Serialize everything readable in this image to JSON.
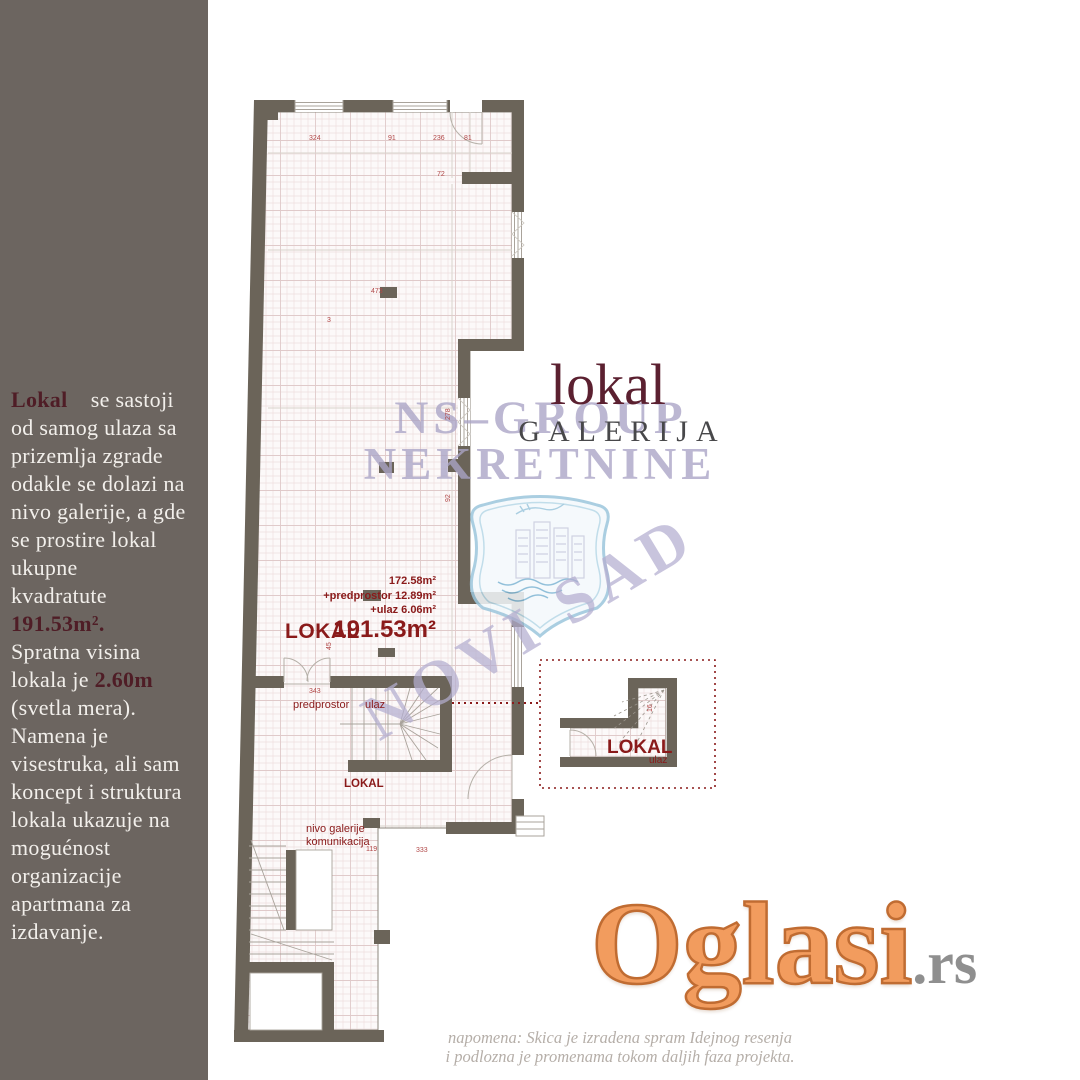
{
  "sidebar": {
    "bg_color": "#6c6560",
    "accent_color": "#4f1d26",
    "segments": [
      {
        "text": "Lokal"
      },
      {
        "text": "    se sastoji\nod samog ulaza sa\nprizemlja zgrade\nodakle se dolazi na\nnivo galerije, a gde\nse prostire lokal\nukupne\nkvadratute\n"
      },
      {
        "text": "191.53m²."
      },
      {
        "text": "\nSpratna visina\nlokala je "
      },
      {
        "text": "2.60m"
      },
      {
        "text": "\n(svetla mera).\nNamena je\nvisestruka, ali sam\nkoncept i struktura\nlokala ukazuje na\nmoguénost\norganizacije\napartmana za\nizdavanje."
      }
    ]
  },
  "title": {
    "line1": "lokal",
    "line2": "GALERIJA",
    "color1": "#5b2030",
    "color2": "#48484a"
  },
  "watermark": {
    "line1": "NS–GROUP",
    "line2": "NEKRETNINE",
    "city": "NOVI SAD",
    "color": "#aaa4c6"
  },
  "plan": {
    "wall_color": "#6b6459",
    "label_color": "#8a1a1a",
    "label_lokal_main": "LOKAL",
    "area_line1": "172.58m²",
    "area_line2": "+predprostor 12.89m²",
    "area_line3": "+ulaz 6.06m²",
    "area_total": "191.53m²",
    "label_predprostor": "predprostor",
    "label_ulaz": "ulaz",
    "label_lokal_small": "LOKAL",
    "label_nivo1": "nivo galerije",
    "label_nivo2": "komunikacija",
    "inset_label_lokal": "LOKAL",
    "inset_label_ulaz": "ulaz",
    "dims": [
      {
        "t": "324"
      },
      {
        "t": "91"
      },
      {
        "t": "236"
      },
      {
        "t": "81"
      },
      {
        "t": "72"
      },
      {
        "t": "473"
      },
      {
        "t": "3"
      },
      {
        "t": "92"
      },
      {
        "t": "278"
      },
      {
        "t": "343"
      },
      {
        "t": "45"
      },
      {
        "t": "16"
      },
      {
        "t": "119"
      },
      {
        "t": "333"
      }
    ]
  },
  "footer": {
    "logo_text": "Oglasi",
    "logo_suffix": ".rs",
    "note_line1": "napomena: Skica je izradena spram Idejnog resenja",
    "note_line2": "i podlozna je promenama tokom daljih faza projekta."
  }
}
